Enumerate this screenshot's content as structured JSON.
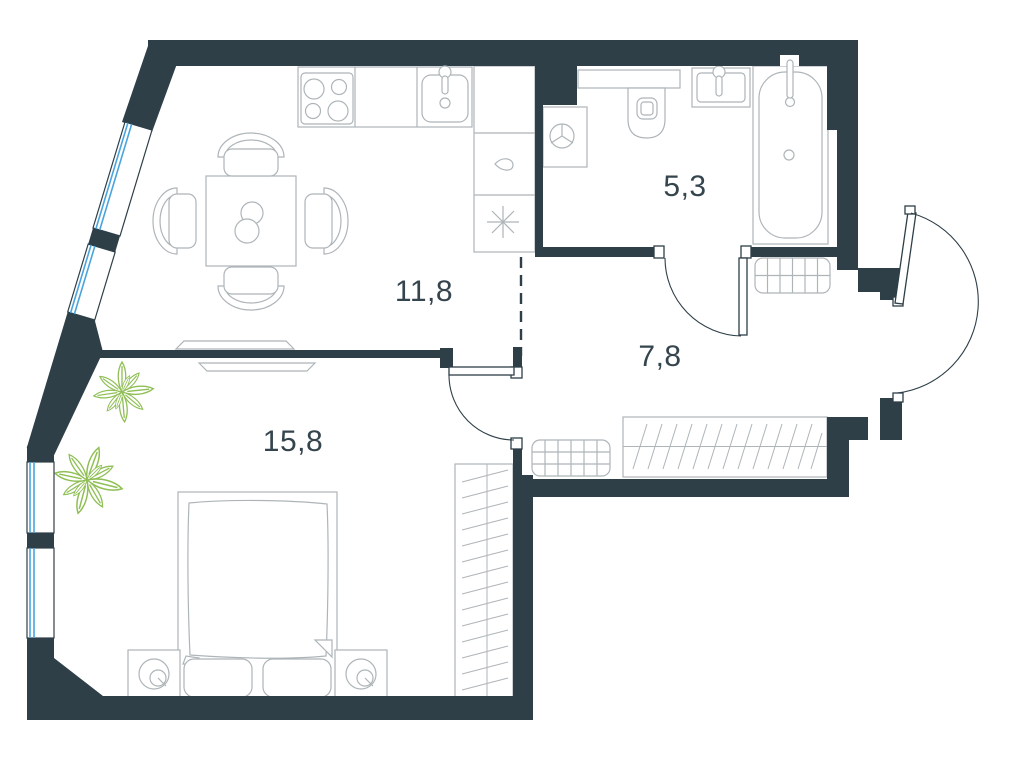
{
  "rooms": [
    {
      "id": "kitchen-dining",
      "area_label": "11,8"
    },
    {
      "id": "bathroom",
      "area_label": "5,3"
    },
    {
      "id": "hallway",
      "area_label": "7,8"
    },
    {
      "id": "bedroom",
      "area_label": "15,8"
    }
  ],
  "colors": {
    "wall": "#2e3f48",
    "background": "#ffffff",
    "furniture_line": "#aeb5b9",
    "window_glass": "#4aa4dc",
    "plant": "#8fbf55",
    "label": "#35454e"
  },
  "fixtures": [
    "stove",
    "kitchen-sink",
    "dishwasher",
    "refrigerator",
    "dining-table",
    "chair",
    "tv-console",
    "washing-machine",
    "toilet",
    "bathroom-sink",
    "bathtub",
    "radiator-grid",
    "shoe-grid",
    "wardrobe",
    "closet",
    "bed",
    "pillow",
    "nightstand-lamp",
    "plant",
    "window",
    "door-swing"
  ]
}
